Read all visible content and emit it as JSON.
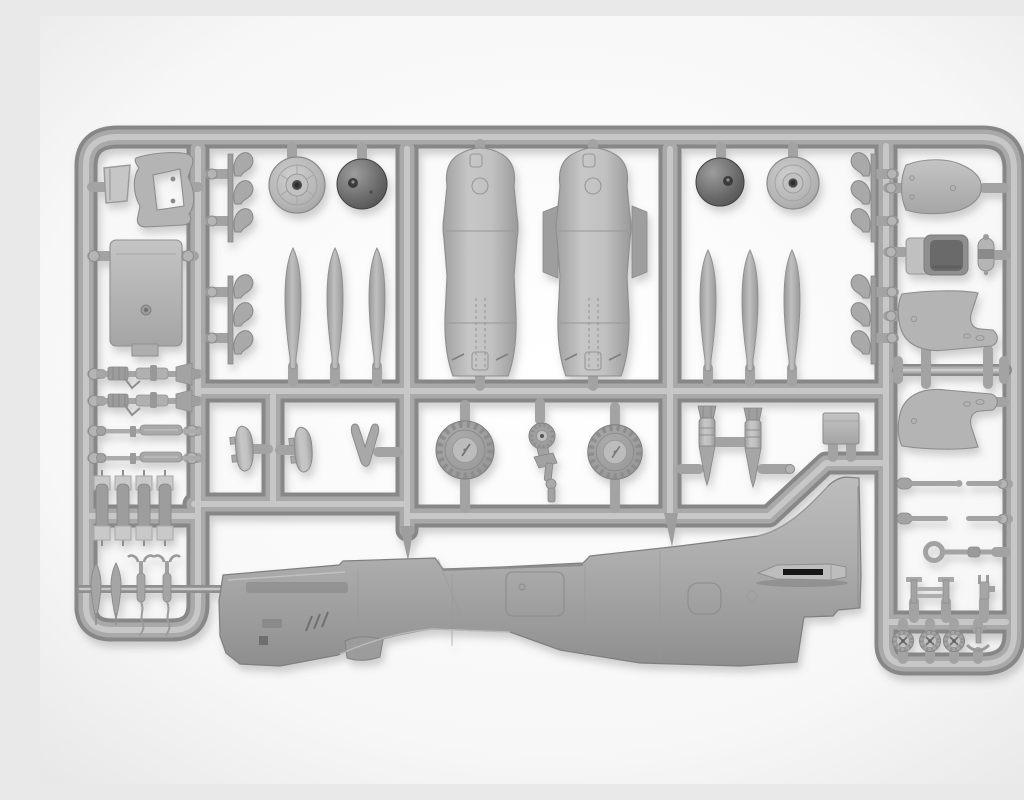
{
  "scene": {
    "title": "Gray injection-molded model aircraft kit sprue on a white background",
    "subject": "Plastic parts frame (sprue) of a piston-engine fighter model kit, photographed top-down",
    "material": "light gray injection-molded polystyrene",
    "background": "seamless white with soft corner vignette",
    "palette": {
      "background": "#f6f6f6",
      "vignette": "#e7e7e7",
      "plastic_base": "#a8a8a8",
      "plastic_highlight": "#cbcbcb",
      "plastic_shadow": "#878787",
      "dark_plastic": "#5f5f5f",
      "black_marking": "#141414"
    },
    "parts": [
      {
        "label": "fuselage half (left side)",
        "quantity": 1
      },
      {
        "label": "cowling / fuselage shell half",
        "quantity": 2
      },
      {
        "label": "propeller blade",
        "quantity": 6
      },
      {
        "label": "spinner dome",
        "quantity": 2
      },
      {
        "label": "spinner backplate",
        "quantity": 2
      },
      {
        "label": "exhaust stack cluster",
        "quantity": 4
      },
      {
        "label": "engine bearer bracket",
        "quantity": 1
      },
      {
        "label": "bulkhead panel",
        "quantity": 1
      },
      {
        "label": "cowl top panel",
        "quantity": 1
      },
      {
        "label": "pilot seat",
        "quantity": 1
      },
      {
        "label": "oxygen bottle",
        "quantity": 1
      },
      {
        "label": "wheel-well half",
        "quantity": 2
      },
      {
        "label": "main landing-gear leg",
        "quantity": 2
      },
      {
        "label": "gear retraction strut",
        "quantity": 2
      },
      {
        "label": "main gear door",
        "quantity": 2
      },
      {
        "label": "tail-gear door fork",
        "quantity": 1
      },
      {
        "label": "main wheel",
        "quantity": 2
      },
      {
        "label": "tail wheel with strut",
        "quantity": 1
      },
      {
        "label": "bomb",
        "quantity": 2
      },
      {
        "label": "finned small bomb",
        "quantity": 4
      },
      {
        "label": "flare / small store",
        "quantity": 4
      },
      {
        "label": "equipment box",
        "quantity": 1
      },
      {
        "label": "actuator rod",
        "quantity": 4
      },
      {
        "label": "grab loop handle",
        "quantity": 1
      },
      {
        "label": "bomb rack frame",
        "quantity": 1
      },
      {
        "label": "small bracket",
        "quantity": 1
      },
      {
        "label": "spoked pulley wheel",
        "quantity": 3
      },
      {
        "label": "control horn",
        "quantity": 1
      }
    ]
  }
}
